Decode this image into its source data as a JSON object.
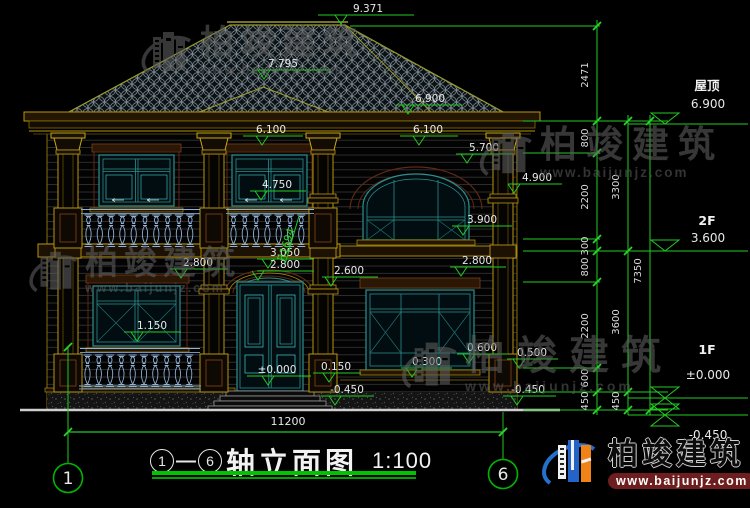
{
  "drawing": {
    "title": {
      "axis_from": "1",
      "axis_to": "6",
      "name": "轴立面图",
      "scale": "1:100"
    },
    "axes": {
      "left": "1",
      "right": "6"
    },
    "overall_width": "11200",
    "radius_label": "R1694",
    "elevation_marks": [
      "9.371",
      "7.795",
      "6.900",
      "6.100",
      "6.100",
      "5.700",
      "4.900",
      "4.750",
      "3.900",
      "3.050",
      "2.800",
      "2.600",
      "2.800",
      "2.800",
      "1.150",
      "±0.000",
      "0.150",
      "-0.450",
      "0.300",
      "0.600",
      "0.500",
      "-0.450"
    ],
    "levels": [
      {
        "name": "屋顶",
        "value": "6.900"
      },
      {
        "name": "2F",
        "value": "3.600"
      },
      {
        "name": "1F",
        "value": "±0.000"
      },
      {
        "name": "",
        "value": "-0.450"
      }
    ],
    "dim_chains": {
      "inner": [
        "2471",
        "800",
        "2200",
        "300",
        "800",
        "2200",
        "600",
        "450"
      ],
      "middle": [
        "3300",
        "3600",
        "450"
      ],
      "outer": [
        "7350"
      ]
    }
  },
  "brand": {
    "name": "柏竣建筑",
    "website": "www.baijunjz.com"
  },
  "colors": {
    "dimension": "#22cc22",
    "text": "#e8e8e8",
    "structure": "#b8960c",
    "frame": "#2e8f8f",
    "watermark": "#5f5f5f",
    "logo_blue": "#2470cc",
    "logo_orange": "#ef8318",
    "banner_red": "#6e1e1e"
  }
}
